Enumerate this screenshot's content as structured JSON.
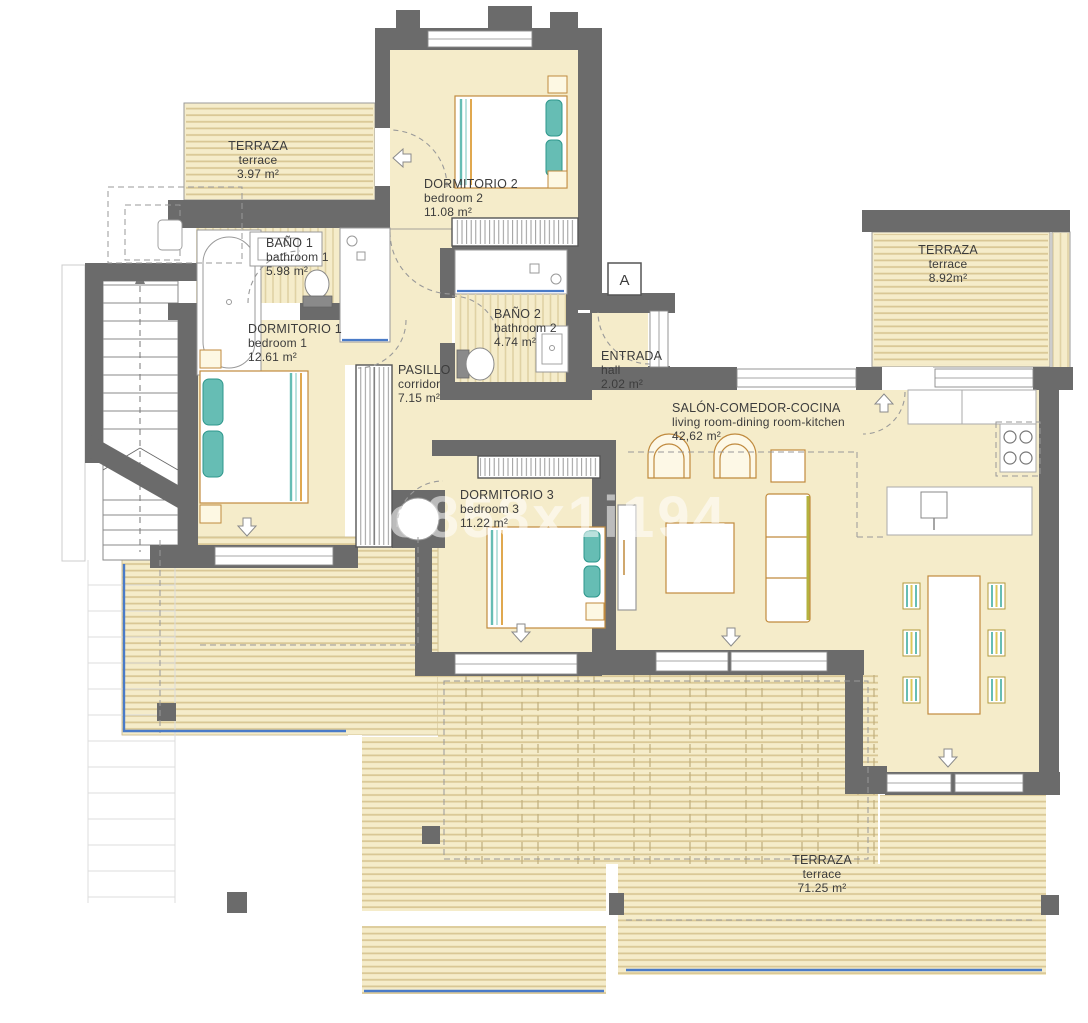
{
  "document_type": "apartment-floor-plan",
  "watermark": "o858x1i194",
  "section_marker": "A",
  "colors": {
    "wall": "#6b6b6b",
    "room_fill": "#f5ecca",
    "terrace_hatch": "#d9c795",
    "teal_accent": "#66bdb4",
    "furniture_accent": "#c08a3e",
    "water_edge_blue": "#4a7bc8",
    "label_text": "#3c3c3c"
  },
  "rooms": [
    {
      "id": "terraza-top-left",
      "name": "TERRAZA",
      "sub": "terrace",
      "area": "3.97 m²"
    },
    {
      "id": "dormitorio-2",
      "name": "DORMITORIO 2",
      "sub": "bedroom 2",
      "area": "11.08 m²"
    },
    {
      "id": "bano-1",
      "name": "BAÑO 1",
      "sub": "bathroom 1",
      "area": "5.98 m²"
    },
    {
      "id": "dormitorio-1",
      "name": "DORMITORIO 1",
      "sub": "bedroom 1",
      "area": "12.61 m²"
    },
    {
      "id": "pasillo",
      "name": "PASILLO",
      "sub": "corridor",
      "area": "7.15 m²"
    },
    {
      "id": "bano-2",
      "name": "BAÑO 2",
      "sub": "bathroom 2",
      "area": "4.74 m²"
    },
    {
      "id": "entrada",
      "name": "ENTRADA",
      "sub": "hall",
      "area": "2.02 m²"
    },
    {
      "id": "terraza-top-right",
      "name": "TERRAZA",
      "sub": "terrace",
      "area": "8.92m²"
    },
    {
      "id": "salon",
      "name": "SALÓN-COMEDOR-COCINA",
      "sub": "living room-dining room-kitchen",
      "area": "42,62 m²"
    },
    {
      "id": "dormitorio-3",
      "name": "DORMITORIO 3",
      "sub": "bedroom 3",
      "area": "11.22 m²"
    },
    {
      "id": "terraza-bottom",
      "name": "TERRAZA",
      "sub": "terrace",
      "area": "71.25 m²"
    }
  ]
}
